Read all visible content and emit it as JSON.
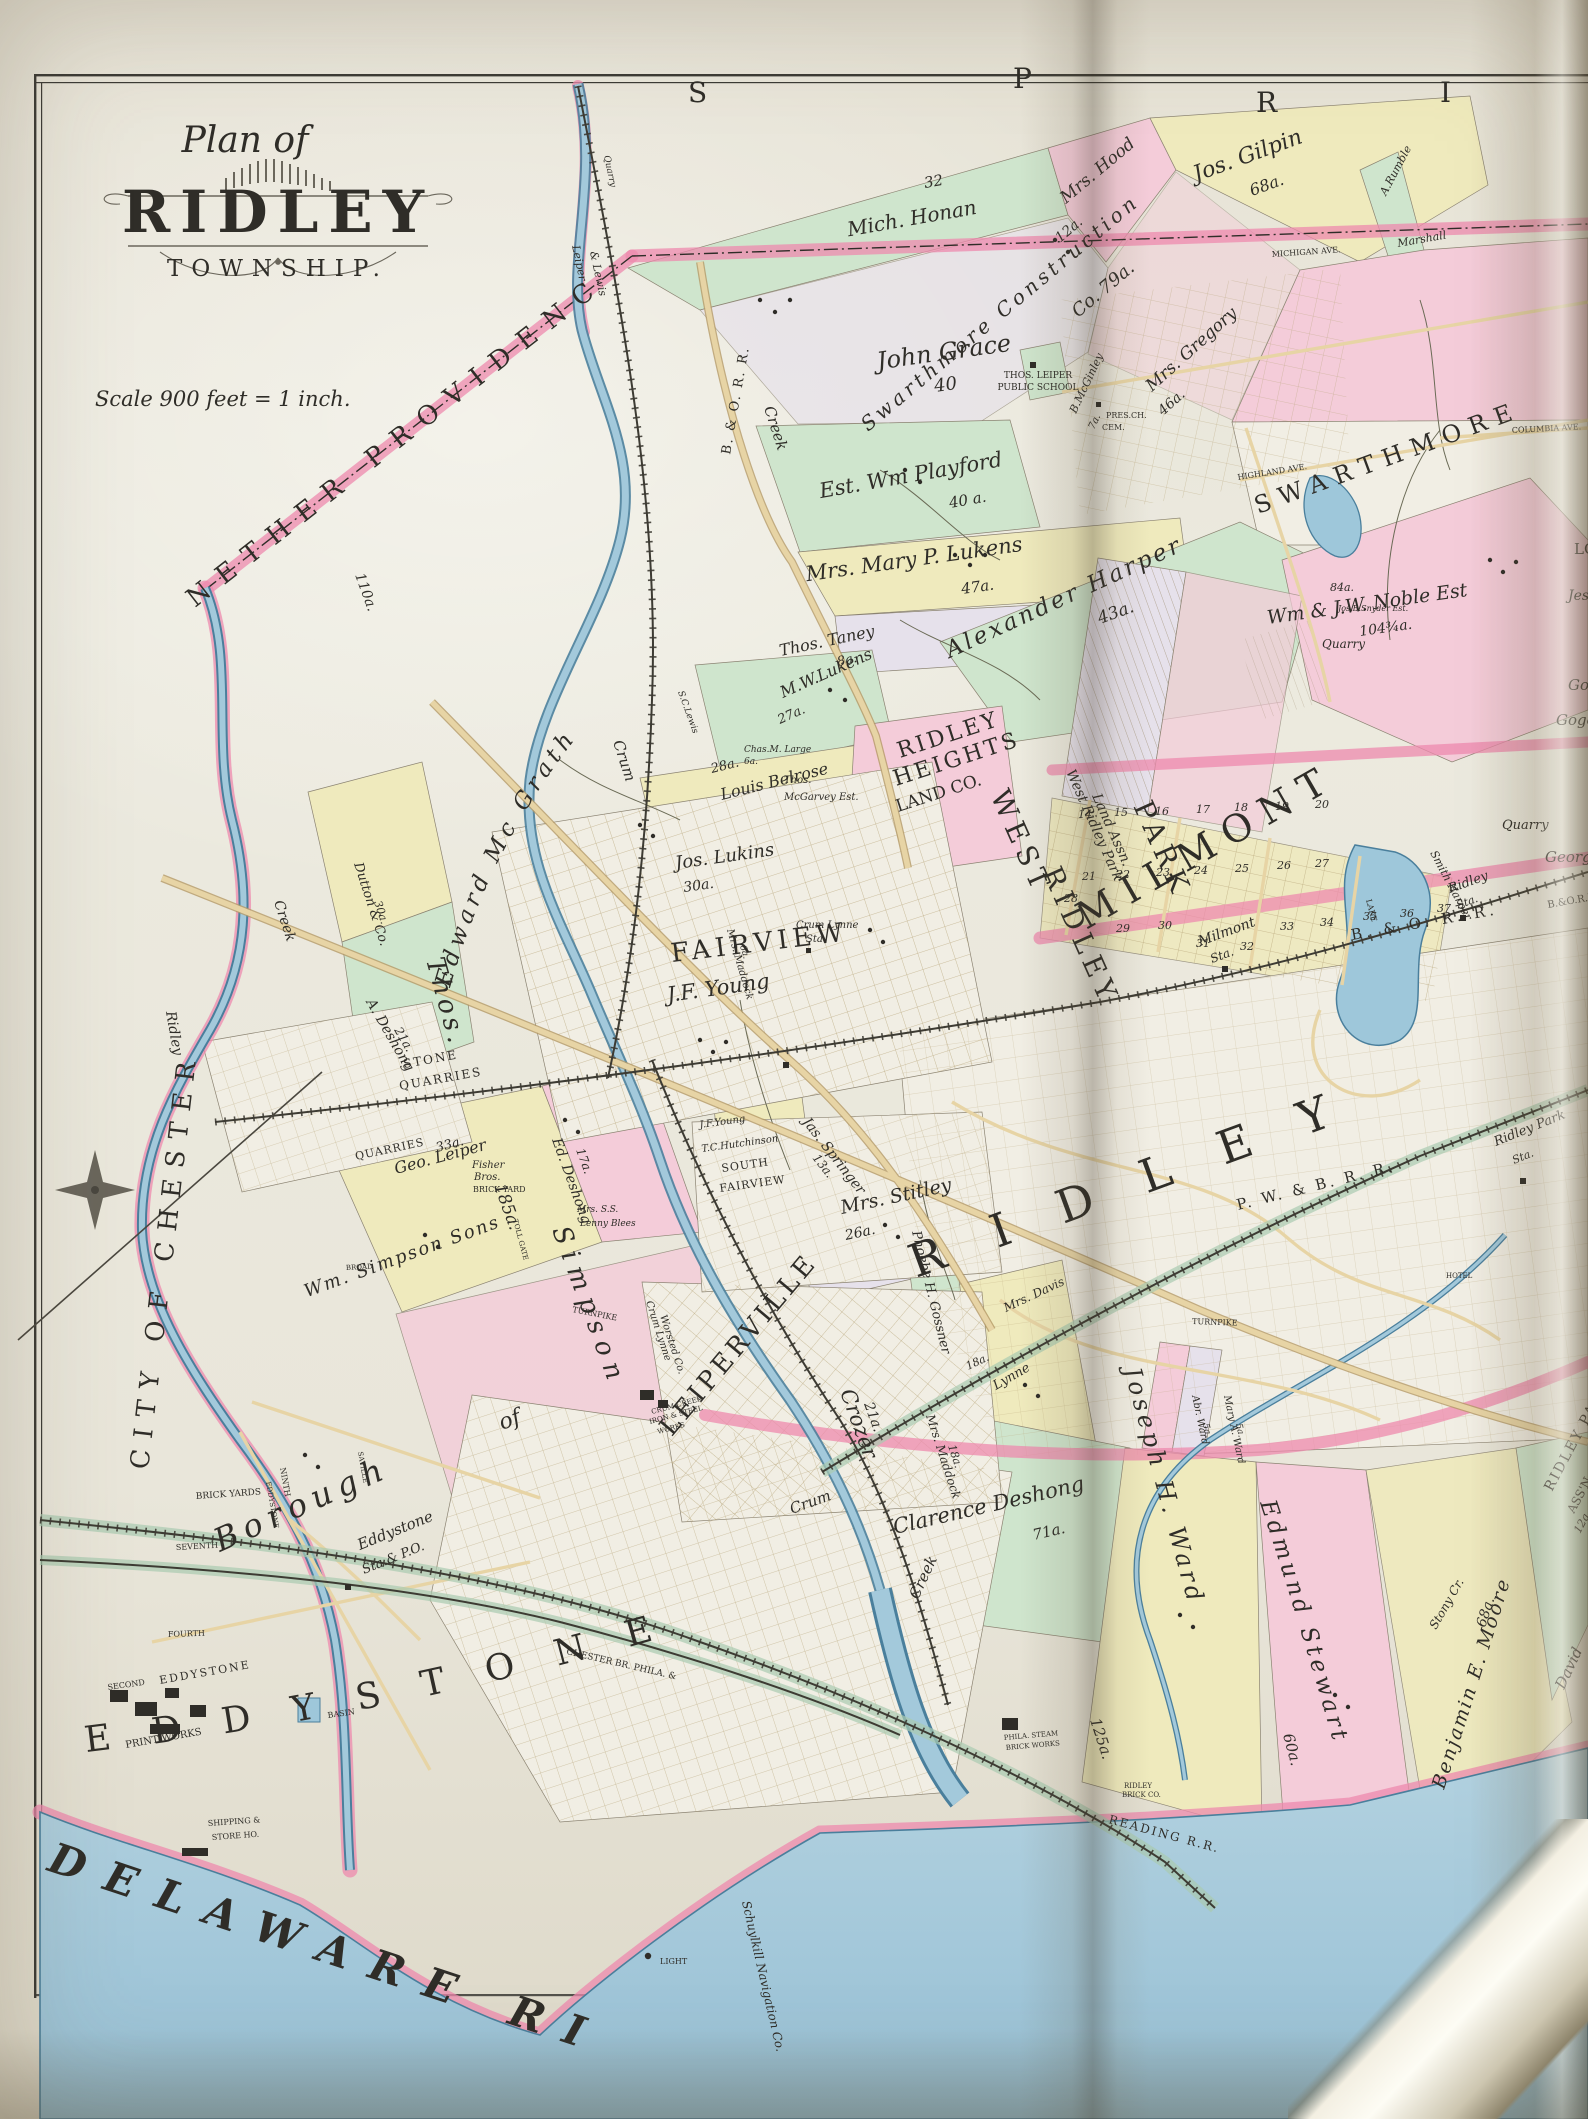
{
  "colors": {
    "paper": "#d9d3c4",
    "sheet": "#edeadf",
    "ink": "#2f2d28",
    "green": "#cfe5cd",
    "yellow": "#efeabd",
    "pink": "#f4ccd9",
    "pinkdeep": "#ee8aae",
    "lav": "#e6e1eb",
    "cream": "#f1eee4",
    "water": "#a3c9db",
    "waterlt": "#c6dde8",
    "road": "#e7d4a5",
    "roadedge": "#b59a66",
    "rail": "#3d3b33",
    "grid": "#b7a478"
  },
  "title": {
    "plan_of": "Plan of",
    "name": "RIDLEY",
    "township": "TOWNSHIP.",
    "scale": "Scale 900 feet = 1 inch."
  },
  "edge": {
    "l0": "S",
    "l1": "P",
    "l2": "R",
    "l3": "I"
  },
  "regions": {
    "nether": "NETHER  PROVIDENCE",
    "chester": "CITY  OF  CHESTER",
    "swarthmore": "SWARTHMORE",
    "milmont": "MILMONT",
    "ridley_big": "RIDLEY",
    "fairview": "FAIRVIEW",
    "south1": "SOUTH",
    "south2": "FAIRVIEW",
    "leiperville": "LEIPERVILLE",
    "eddystone": "EDDYSTONE",
    "borough": "Borough",
    "of": "of",
    "west": "WEST",
    "ridley2": "RIDLEY",
    "park": "PARK",
    "delaware": "DELAWARE   RIVER",
    "heights1": "RIDLEY",
    "heights2": "HEIGHTS",
    "heights3": "LAND  CO.",
    "thos": "Thos.",
    "simpson": "Simpson",
    "simpson_a": "185a.",
    "simpson_sons": "Wm. Simpson Sons"
  },
  "parcels": {
    "honan": "Mich. Honan",
    "honan_a": "32",
    "hood": "Mrs. Hood",
    "hood_a": "12a.",
    "gilpin": "Jos. Gilpin",
    "gilpin_a": "68a.",
    "grace": "John Grace",
    "grace_a": "40",
    "school1": "THOS. LEIPER",
    "school2": "PUBLIC SCHOOL",
    "pres": "PRES.CH.",
    "cem": "CEM.",
    "mcginley": "B.McGinley",
    "mcginley_a": "7a.",
    "gregory": "Mrs. Gregory",
    "gregory_a": "46a.",
    "swcon": "Swarthmore Construction",
    "swcon_a": "Co. 79a.",
    "rumble": "A.Rumble",
    "marshall": "Marshall",
    "playford": "Est. Wm Playford",
    "playford_a": "40 a.",
    "mlukens": "Mrs. Mary P. Lukens",
    "mlukens_a": "47a.",
    "taney": "Thos. Taney",
    "taney_a": "8a.",
    "harper": "Alexander Harper",
    "harper_a": "43a.",
    "noble": "Wm & J.W. Noble Est",
    "noble_a": "104¾a.",
    "mwlukens": "M.W.Lukens",
    "mwlukens_a": "27a.",
    "belrose": "Louis Belrose",
    "belrose_a": "28a.",
    "lukins": "Jos. Lukins",
    "lukins_a": "30a.",
    "mcgrath": "Edward Mc Grath",
    "mcgrath_a": "110a.",
    "dutton": "Dutton & Co.",
    "dutton_a": "30a.",
    "adeshong": "A. Deshong",
    "adeshong_a": "21a.",
    "stone": "STONE",
    "quarries": "QUARRIES",
    "quarries2": "QUARRIES",
    "gleiper": "Geo. Leiper",
    "gleiper_a": "33a.",
    "fisher1": "Fisher",
    "fisher2": "Bros.",
    "fisher3": "BRICK YARD",
    "edeshong": "Ed. Deshong",
    "edeshong_a": "17a.",
    "lenny1": "Mrs. S.S.",
    "lenny2": "Lenny  Blees",
    "toll": "TOLL GATE",
    "young": "J.F. Young",
    "young2": "J.F.Young",
    "hutchinson": "T.C.Hutchinson",
    "springer": "Jas. Springer",
    "springer_a": "13a.",
    "stitley": "Mrs. Stitley",
    "stitley_a": "26a.",
    "gossner": "Phoebe H. Gossner",
    "maddock6": "Mrs. Maddock",
    "maddock6_a": "6a.",
    "maddock18": "Mrs. Maddock",
    "maddock18_a": "18a.",
    "davis": "Mrs. Davis",
    "davis_a": "18a.",
    "crozer": "Crozer",
    "crozer_a": "21a.",
    "clarence": "Clarence Deshong",
    "clarence_a": "71a.",
    "jward": "Joseph H. Ward",
    "jward_a": "125a.",
    "stewart": "Edmund Stewart",
    "stewart_a": "60a.",
    "moore": "Benjamin E. Moore",
    "moore_a": "68a.",
    "abrward": "Abr. Ward",
    "abrward_a": "5a.",
    "maryward": "Mary A. Ward",
    "maryward_a": "5a.",
    "rpassn1": "RIDLEY PARK",
    "rpassn2": "ASS'N.",
    "rpassn3": "12a.",
    "wrp1": "West Ridley Park",
    "wrp2": "Land Assn.",
    "mcgarvey1": "Thos.",
    "mcgarvey2": "McGarvey Est.",
    "large1": "Chas.M. Large",
    "large2": "6a.",
    "snyder": "Jos.B.Snyder Est.",
    "snyder_a": "84a.",
    "quarry2": "Quarry",
    "quarry3": "Quarry",
    "george": "George",
    "smithharper": "Smith Harper",
    "jes": "Jes",
    "lo": "LO",
    "go": "Go",
    "goge": "Goge",
    "david": "David",
    "t": "T",
    "hotel": "HOTEL"
  },
  "infra": {
    "bo": "B. & O. R. R.",
    "bo2": "B. & O. R. R.",
    "bo3": "B.&O.R.R.",
    "pwb": "P. W. & B. R. R.",
    "reading1": "CHESTER BR. PHILA. &",
    "reading2": "READING R.R.",
    "schuylkill": "Schuylkill Navigation Co.",
    "milmont_sta1": "Milmont",
    "milmont_sta2": "Sta.",
    "ridley_sta1": "Ridley",
    "ridley_sta2": "Sta.",
    "rp_sta1": "Ridley Park",
    "rp_sta2": "Sta.",
    "cl_sta1": "Crum Lynne",
    "cl_sta2": "Sta.",
    "eddy_sta1": "Eddystone",
    "eddy_sta2": "Sta.& P.O.",
    "light": "LIGHT",
    "ship1": "SHIPPING &",
    "ship2": "STORE HO.",
    "print1": "EDDYSTONE",
    "print2": "PRINT WORKS",
    "pbrick1": "PHILA. STEAM",
    "pbrick2": "BRICK WORKS",
    "rbrick1": "RIDLEY",
    "rbrick2": "BRICK CO.",
    "ciron1": "CRUM CREEK",
    "ciron2": "IRON & STEEL",
    "ciron3": "WORKS",
    "worsted1": "Crum Lynne",
    "worsted2": "Worsted Co.",
    "basin": "BASIN",
    "brickyards": "BRICK YARDS",
    "turnpike1": "TURNPIKE",
    "turnpike2": "TURNPIKE",
    "highland": "HIGHLAND AVE.",
    "columbia": "COLUMBIA AVE.",
    "michigan": "MICHIGAN AVE.",
    "ninth": "NINTH",
    "seventh": "SEVENTH",
    "fourth": "FOURTH",
    "second": "SECOND",
    "eddyst": "EDDYSTONE",
    "saville": "SAVILLE",
    "broad": "BROAD",
    "ll1": "Leiper",
    "ll2": "& Lewis",
    "quarry1": "Quarry"
  },
  "water": {
    "crum1": "Crum",
    "creek1": "Creek",
    "crum2": "Crum",
    "creek2": "Creek",
    "ridley1": "Ridley",
    "ridley2": "Creek",
    "stony": "Stony Cr.",
    "lake": "LAKE",
    "sclewis": "S.C.Lewis",
    "lynne": "Lynne"
  },
  "blocks": [
    "14",
    "15",
    "16",
    "17",
    "18",
    "19",
    "20",
    "21",
    "22",
    "23",
    "24",
    "25",
    "26",
    "27",
    "28",
    "29",
    "30",
    "31",
    "32",
    "33",
    "34",
    "35",
    "36",
    "37"
  ]
}
